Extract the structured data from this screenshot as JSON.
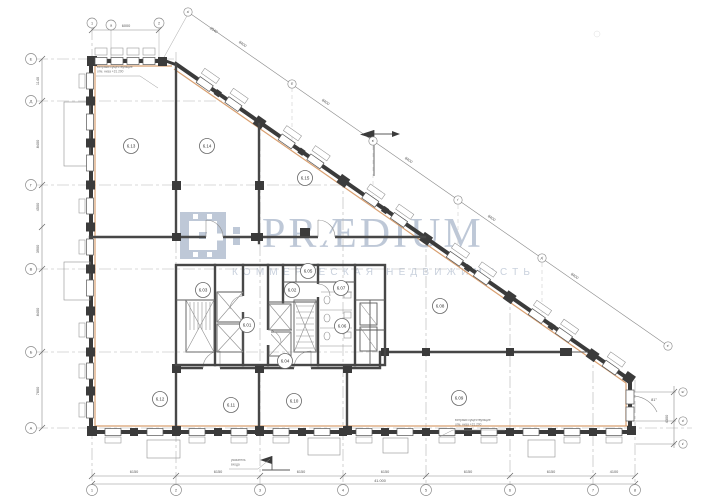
{
  "watermark": {
    "brand": "PRÆDIUM",
    "subtitle": "КОММЕРЧЕСКАЯ НЕДВИЖИМОСТЬ"
  },
  "colors": {
    "wall": "#3b3b3b",
    "accent_insulation": "#d79b69",
    "watermark": "#b6c1d2",
    "grid": "#b3b3b3"
  },
  "plan": {
    "rooms": [
      {
        "label": "6.01",
        "x": 247,
        "y": 325
      },
      {
        "label": "6.02",
        "x": 292,
        "y": 290
      },
      {
        "label": "6.03",
        "x": 203,
        "y": 290
      },
      {
        "label": "6.04",
        "x": 285,
        "y": 361
      },
      {
        "label": "6.05",
        "x": 308,
        "y": 271
      },
      {
        "label": "6.06",
        "x": 342,
        "y": 326
      },
      {
        "label": "6.07",
        "x": 341,
        "y": 288
      },
      {
        "label": "6.08",
        "x": 440,
        "y": 306
      },
      {
        "label": "6.09",
        "x": 459,
        "y": 398
      },
      {
        "label": "6.10",
        "x": 294,
        "y": 401
      },
      {
        "label": "6.11",
        "x": 231,
        "y": 405
      },
      {
        "label": "6.12",
        "x": 160,
        "y": 399
      },
      {
        "label": "6.13",
        "x": 131,
        "y": 146
      },
      {
        "label": "6.14",
        "x": 207,
        "y": 146
      },
      {
        "label": "6.15",
        "x": 305,
        "y": 178
      }
    ],
    "axis_bubbles": {
      "left": [
        {
          "label": "Е",
          "x": 31,
          "y": 59
        },
        {
          "label": "Д",
          "x": 31,
          "y": 101
        },
        {
          "label": "Г",
          "x": 31,
          "y": 185
        },
        {
          "label": "В",
          "x": 31,
          "y": 269
        },
        {
          "label": "Б",
          "x": 31,
          "y": 352
        },
        {
          "label": "А",
          "x": 31,
          "y": 428
        }
      ],
      "top": [
        {
          "label": "1",
          "x": 92,
          "y": 23
        },
        {
          "label": "а",
          "x": 111,
          "y": 25
        },
        {
          "label": "2",
          "x": 159,
          "y": 23
        }
      ],
      "bottom": [
        {
          "label": "1",
          "x": 92,
          "y": 490
        },
        {
          "label": "2",
          "x": 176,
          "y": 490
        },
        {
          "label": "3",
          "x": 260,
          "y": 490
        },
        {
          "label": "4",
          "x": 343,
          "y": 490
        },
        {
          "label": "5",
          "x": 426,
          "y": 490
        },
        {
          "label": "6",
          "x": 510,
          "y": 490
        },
        {
          "label": "7",
          "x": 593,
          "y": 490
        },
        {
          "label": "8",
          "x": 635,
          "y": 490
        }
      ],
      "diagonal": [
        {
          "label": "а'",
          "x": 188,
          "y": 12
        },
        {
          "label": "б'",
          "x": 292,
          "y": 84
        },
        {
          "label": "в'",
          "x": 373,
          "y": 141
        },
        {
          "label": "г'",
          "x": 458,
          "y": 200
        },
        {
          "label": "д'",
          "x": 542,
          "y": 258
        },
        {
          "label": "е'",
          "x": 668,
          "y": 346
        }
      ],
      "right": [
        {
          "label": "ж'",
          "x": 683,
          "y": 392
        },
        {
          "label": "и'",
          "x": 683,
          "y": 421
        },
        {
          "label": "к'",
          "x": 683,
          "y": 444
        }
      ]
    },
    "dimensions": [
      {
        "text": "6000",
        "x": 126,
        "y": 27,
        "rot": 0
      },
      {
        "text": "2540",
        "x": 213,
        "y": 31,
        "rot": 35
      },
      {
        "text": "1140",
        "x": 39,
        "y": 81,
        "rot": -90
      },
      {
        "text": "8400",
        "x": 39,
        "y": 144,
        "rot": -90
      },
      {
        "text": "4500",
        "x": 39,
        "y": 207,
        "rot": -90
      },
      {
        "text": "3900",
        "x": 39,
        "y": 249,
        "rot": -90
      },
      {
        "text": "8400",
        "x": 39,
        "y": 312,
        "rot": -90
      },
      {
        "text": "7600",
        "x": 39,
        "y": 391,
        "rot": -90
      },
      {
        "text": "6150",
        "x": 134,
        "y": 473,
        "rot": 0
      },
      {
        "text": "6150",
        "x": 218,
        "y": 473,
        "rot": 0
      },
      {
        "text": "6150",
        "x": 301,
        "y": 473,
        "rot": 0
      },
      {
        "text": "6150",
        "x": 385,
        "y": 473,
        "rot": 0
      },
      {
        "text": "6150",
        "x": 468,
        "y": 473,
        "rot": 0
      },
      {
        "text": "6150",
        "x": 551,
        "y": 473,
        "rot": 0
      },
      {
        "text": "4100",
        "x": 614,
        "y": 473,
        "rot": 0
      },
      {
        "text": "41.000",
        "x": 380,
        "y": 482,
        "rot": 0
      },
      {
        "text": "8400",
        "x": 242,
        "y": 45,
        "rot": 35
      },
      {
        "text": "8400",
        "x": 325,
        "y": 103,
        "rot": 35
      },
      {
        "text": "8400",
        "x": 408,
        "y": 161,
        "rot": 35
      },
      {
        "text": "8400",
        "x": 491,
        "y": 219,
        "rot": 35
      },
      {
        "text": "8400",
        "x": 574,
        "y": 277,
        "rot": 35
      },
      {
        "text": "4300",
        "x": 668,
        "y": 419,
        "rot": -90
      },
      {
        "text": "81°",
        "x": 654,
        "y": 401,
        "rot": 0
      }
    ],
    "annotations": [
      {
        "x": 97,
        "y": 68,
        "lines": [
          "витражи существующие",
          "отм. низа +31.200"
        ],
        "underline": [
          96,
          76,
          140,
          76
        ],
        "leader": [
          140,
          76,
          158,
          88
        ]
      },
      {
        "x": 455,
        "y": 421,
        "lines": [
          "витражи существующие",
          "отм. низа +31.200"
        ],
        "underline": [
          453,
          430,
          505,
          430
        ],
        "leader": [
          453,
          430,
          439,
          437
        ]
      },
      {
        "x": 231,
        "y": 461,
        "lines": [
          "указатель",
          "входа"
        ],
        "underline": [
          229,
          469,
          258,
          469
        ],
        "leader": [
          258,
          469,
          270,
          459
        ]
      }
    ]
  }
}
